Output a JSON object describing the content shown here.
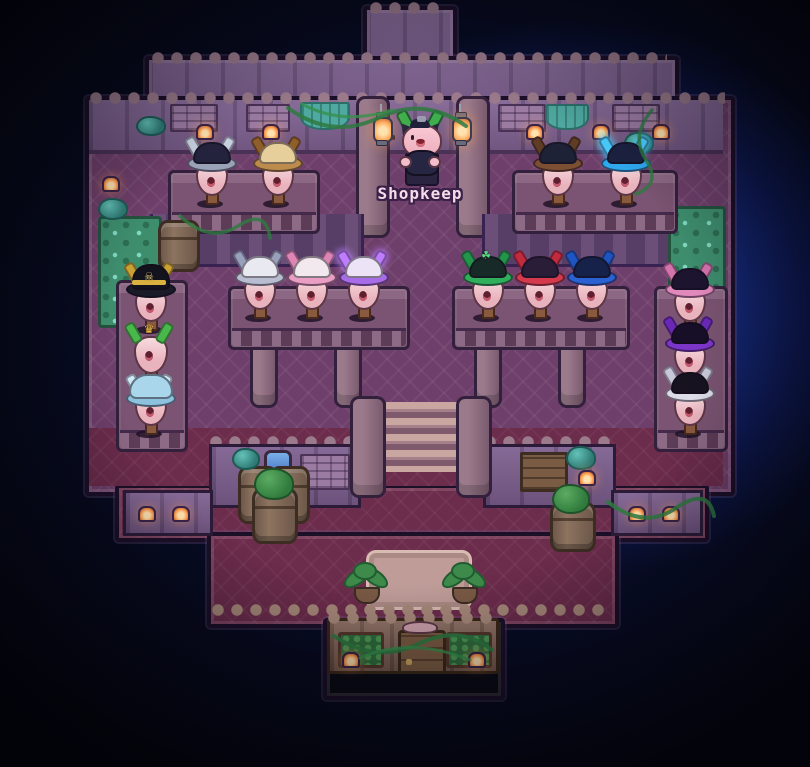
{
  "scene": {
    "game_view": "pixel-art hat shop interior",
    "width": 810,
    "height": 767
  },
  "shopkeep": {
    "label": "Shopkeep",
    "x": 420,
    "y": 110
  },
  "lanterns": [
    {
      "x": 371,
      "y": 104
    },
    {
      "x": 450,
      "y": 104
    }
  ],
  "creature_groups": [
    "top-left-table",
    "top-right-table",
    "mid-left-table",
    "mid-right-table",
    "left-rack",
    "right-rack"
  ],
  "creatures": [
    {
      "id": "navy-silver",
      "group": "top-left-table",
      "hat": "navy and silver tricorn",
      "x": 210,
      "y": 136,
      "style": "tricorn",
      "dome": "#23233d",
      "brim": "#9aa2b8",
      "spike": "#c8d0e0"
    },
    {
      "id": "tan-leather",
      "group": "top-left-table",
      "hat": "tan leather tricorn",
      "x": 276,
      "y": 136,
      "style": "tricorn",
      "dome": "#e6cf9a",
      "brim": "#bd8c4c",
      "spike": "#8f5e2a"
    },
    {
      "id": "brown-dark",
      "group": "top-right-table",
      "hat": "dark tricorn with brown trim",
      "x": 556,
      "y": 136,
      "style": "tricorn",
      "dome": "#1e2236",
      "brim": "#7c4f33",
      "spike": "#5f3d24"
    },
    {
      "id": "cyan-glow",
      "group": "top-right-table",
      "hat": "dark tricorn with glowing cyan trim",
      "x": 624,
      "y": 136,
      "style": "tricorn",
      "glow": true,
      "dome": "#1b2140",
      "brim": "#2fa8ee",
      "spike": "#49ccff"
    },
    {
      "id": "white-silver",
      "group": "mid-left-table",
      "hat": "white tricorn with silver trim",
      "x": 258,
      "y": 250,
      "style": "tricorn",
      "dome": "#e9e9f2",
      "brim": "#b9bdd2",
      "spike": "#99a0bc"
    },
    {
      "id": "white-pink",
      "group": "mid-left-table",
      "hat": "white tricorn with pink trim",
      "x": 310,
      "y": 250,
      "style": "tricorn",
      "dome": "#f2e9ef",
      "brim": "#eb9ec4",
      "spike": "#dd85b4"
    },
    {
      "id": "white-violet",
      "group": "mid-left-table",
      "hat": "white tricorn with glowing violet trim",
      "x": 362,
      "y": 250,
      "style": "tricorn",
      "glow": true,
      "dome": "#ece4f6",
      "brim": "#a86ce8",
      "spike": "#be7dff"
    },
    {
      "id": "green-clover",
      "group": "mid-right-table",
      "hat": "dark tricorn with green trim and clover",
      "x": 486,
      "y": 250,
      "style": "tricorn",
      "dome": "#182a28",
      "brim": "#2fae5c",
      "spike": "#23954b",
      "emblem": "☘",
      "emblem_color": "#54e080"
    },
    {
      "id": "red-trim",
      "group": "mid-right-table",
      "hat": "dark hat with red trim",
      "x": 538,
      "y": 250,
      "style": "tricorn",
      "dome": "#2a1d38",
      "brim": "#d53a4c",
      "spike": "#c22a3e"
    },
    {
      "id": "blue-trim",
      "group": "mid-right-table",
      "hat": "dark tricorn with blue trim",
      "x": 590,
      "y": 250,
      "style": "tricorn",
      "dome": "#16224a",
      "brim": "#2a62d4",
      "spike": "#1f55c2"
    },
    {
      "id": "pirate-captain",
      "group": "left-rack",
      "hat": "black pirate captain hat with gold skull",
      "x": 149,
      "y": 262,
      "style": "pirate",
      "dome": "#13131d",
      "brim": "#1a1a28",
      "spike": "#c9a032",
      "band": "#d9b13f",
      "emblem": "☠",
      "emblem_color": "#e8cf7a"
    },
    {
      "id": "crown-bare",
      "group": "left-rack",
      "hat": "bare head with green horns and gold crown",
      "x": 149,
      "y": 316,
      "style": "bare",
      "spike": "#49b84a",
      "emblem": "♛",
      "emblem_color": "#e6b93f"
    },
    {
      "id": "powder-blue",
      "group": "left-rack",
      "hat": "powder blue cap",
      "x": 149,
      "y": 366,
      "style": "cap",
      "dome": "#a9d6ea",
      "brim": "#8cc2de",
      "spike": "#cfe9f5"
    },
    {
      "id": "shadow-pink",
      "group": "right-rack",
      "hat": "shadow tricorn with pink trim",
      "x": 688,
      "y": 262,
      "style": "tricorn",
      "dome": "#1d1430",
      "brim": "#e289bc",
      "spike": "#d573ad"
    },
    {
      "id": "shadow-violet",
      "group": "right-rack",
      "hat": "shadow tricorn with violet trim",
      "x": 688,
      "y": 316,
      "style": "tricorn",
      "dome": "#170f28",
      "brim": "#7c35c9",
      "spike": "#6b28b8"
    },
    {
      "id": "shadow-white",
      "group": "right-rack",
      "hat": "shadow tricorn with white trim",
      "x": 688,
      "y": 366,
      "style": "tricorn",
      "dome": "#17121f",
      "brim": "#dcdce8",
      "spike": "#c8c8da"
    }
  ],
  "palette": {
    "background": "#04050c",
    "glow_blue": "#2650dc",
    "wall_stone": "#806292",
    "wall_tan": "#8a6a5c",
    "floor_upper": "#6e3f6a",
    "floor_lower": "#6c2c4b",
    "hedge_green": "#3e8e6e",
    "vine_green": "#2e7a40",
    "lantern_glow": "#ffab5e",
    "label_text": "#f6dcea",
    "outline_dark": "#1c0f28"
  }
}
